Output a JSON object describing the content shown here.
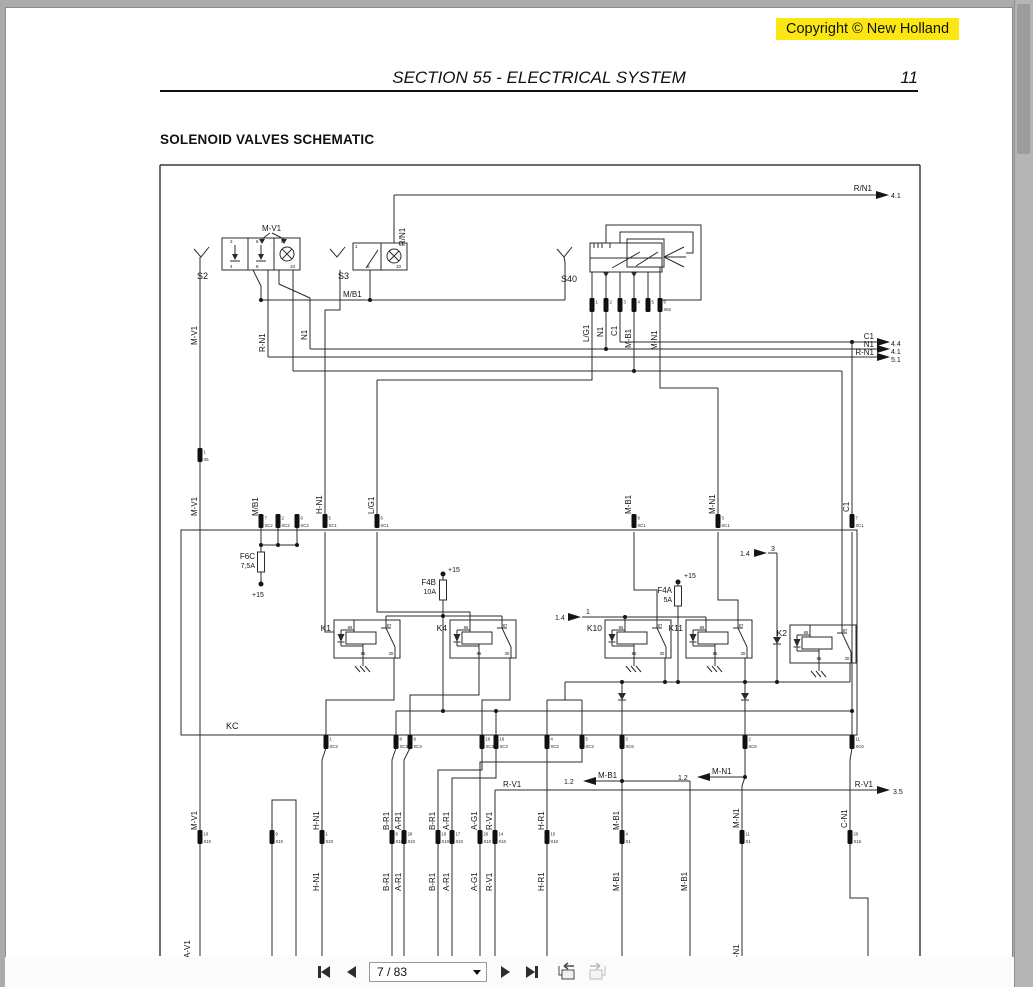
{
  "page": {
    "copyright": "Copyright © New Holland",
    "copyright_bg": "#fce712",
    "section_title": "SECTION 55 - ELECTRICAL SYSTEM",
    "page_number": "11",
    "heading": "SOLENOID VALVES SCHEMATIC"
  },
  "toolbar": {
    "page_indicator": "7 / 83"
  },
  "schematic": {
    "wire_color": "#2b2b2b",
    "labels": [
      {
        "t": "M-V1",
        "x": 262,
        "y": 231
      },
      {
        "t": "S2",
        "x": 197,
        "y": 279,
        "s": 9
      },
      {
        "t": "S3",
        "x": 338,
        "y": 279,
        "s": 9
      },
      {
        "t": "S40",
        "x": 561,
        "y": 282,
        "s": 9
      },
      {
        "t": "R/N1",
        "x": 405,
        "y": 246,
        "r": 1
      },
      {
        "t": "M/B1",
        "x": 343,
        "y": 297
      },
      {
        "t": "R/N1",
        "x": 872,
        "y": 191,
        "a": "e"
      },
      {
        "t": "4.1",
        "x": 891,
        "y": 198,
        "s": 7
      },
      {
        "t": "C1",
        "x": 874,
        "y": 339,
        "a": "e"
      },
      {
        "t": "4.4",
        "x": 891,
        "y": 346,
        "s": 7
      },
      {
        "t": "N1",
        "x": 874,
        "y": 347,
        "a": "e"
      },
      {
        "t": "4.1",
        "x": 891,
        "y": 354,
        "s": 7
      },
      {
        "t": "R-N1",
        "x": 874,
        "y": 355,
        "a": "e"
      },
      {
        "t": "5.1",
        "x": 891,
        "y": 362,
        "s": 7
      },
      {
        "t": "M-V1",
        "x": 197,
        "y": 345,
        "r": 1
      },
      {
        "t": "R-N1",
        "x": 265,
        "y": 352,
        "r": 1
      },
      {
        "t": "N1",
        "x": 307,
        "y": 340,
        "r": 1
      },
      {
        "t": "L/G1",
        "x": 589,
        "y": 342,
        "r": 1
      },
      {
        "t": "N1",
        "x": 603,
        "y": 337,
        "r": 1
      },
      {
        "t": "C1",
        "x": 617,
        "y": 336,
        "r": 1
      },
      {
        "t": "M-B1",
        "x": 631,
        "y": 348,
        "r": 1
      },
      {
        "t": "M-N1",
        "x": 657,
        "y": 350,
        "r": 1
      },
      {
        "t": "M-V1",
        "x": 197,
        "y": 516,
        "r": 1
      },
      {
        "t": "M/B1",
        "x": 258,
        "y": 516,
        "r": 1
      },
      {
        "t": "H-N1",
        "x": 322,
        "y": 514,
        "r": 1
      },
      {
        "t": "L/G1",
        "x": 374,
        "y": 514,
        "r": 1
      },
      {
        "t": "M-B1",
        "x": 631,
        "y": 514,
        "r": 1
      },
      {
        "t": "M-N1",
        "x": 715,
        "y": 514,
        "r": 1
      },
      {
        "t": "C1",
        "x": 849,
        "y": 512,
        "r": 1
      },
      {
        "t": "F6C",
        "x": 255,
        "y": 559,
        "a": "e"
      },
      {
        "t": "7,5A",
        "x": 255,
        "y": 568,
        "a": "e",
        "s": 7
      },
      {
        "t": "+15",
        "x": 252,
        "y": 597,
        "s": 7
      },
      {
        "t": "F4B",
        "x": 436,
        "y": 585,
        "a": "e"
      },
      {
        "t": "10A",
        "x": 436,
        "y": 594,
        "a": "e",
        "s": 7
      },
      {
        "t": "+15",
        "x": 448,
        "y": 572,
        "s": 7
      },
      {
        "t": "F4A",
        "x": 672,
        "y": 593,
        "a": "e"
      },
      {
        "t": "5A",
        "x": 672,
        "y": 602,
        "a": "e",
        "s": 7
      },
      {
        "t": "+15",
        "x": 684,
        "y": 578,
        "s": 7
      },
      {
        "t": "1.4",
        "x": 555,
        "y": 620,
        "s": 7
      },
      {
        "t": "1",
        "x": 586,
        "y": 614,
        "s": 7
      },
      {
        "t": "1.4",
        "x": 740,
        "y": 556,
        "s": 7
      },
      {
        "t": "3",
        "x": 771,
        "y": 551,
        "s": 7
      },
      {
        "t": "KC",
        "x": 226,
        "y": 729,
        "s": 9
      },
      {
        "t": "1.2",
        "x": 564,
        "y": 784,
        "s": 7
      },
      {
        "t": "M-B1",
        "x": 598,
        "y": 778
      },
      {
        "t": "1.2",
        "x": 678,
        "y": 780,
        "s": 7
      },
      {
        "t": "M-N1",
        "x": 712,
        "y": 774
      },
      {
        "t": "R-V1",
        "x": 503,
        "y": 787
      },
      {
        "t": "R-V1",
        "x": 873,
        "y": 787,
        "a": "e"
      },
      {
        "t": "3.5",
        "x": 893,
        "y": 794,
        "s": 7
      },
      {
        "t": "M-V1",
        "x": 197,
        "y": 830,
        "r": 1
      },
      {
        "t": "H-N1",
        "x": 319,
        "y": 830,
        "r": 1
      },
      {
        "t": "B-R1",
        "x": 389,
        "y": 830,
        "r": 1
      },
      {
        "t": "A-R1",
        "x": 401,
        "y": 830,
        "r": 1
      },
      {
        "t": "B-R1",
        "x": 435,
        "y": 830,
        "r": 1
      },
      {
        "t": "A-R1",
        "x": 449,
        "y": 830,
        "r": 1
      },
      {
        "t": "A-G1",
        "x": 477,
        "y": 830,
        "r": 1
      },
      {
        "t": "R-V1",
        "x": 492,
        "y": 830,
        "r": 1
      },
      {
        "t": "H-R1",
        "x": 544,
        "y": 830,
        "r": 1
      },
      {
        "t": "M-B1",
        "x": 619,
        "y": 830,
        "r": 1
      },
      {
        "t": "M-N1",
        "x": 739,
        "y": 828,
        "r": 1
      },
      {
        "t": "C-N1",
        "x": 847,
        "y": 828,
        "r": 1
      },
      {
        "t": "H-N1",
        "x": 319,
        "y": 891,
        "r": 1
      },
      {
        "t": "B-R1",
        "x": 389,
        "y": 891,
        "r": 1
      },
      {
        "t": "A-R1",
        "x": 401,
        "y": 891,
        "r": 1
      },
      {
        "t": "B-R1",
        "x": 435,
        "y": 891,
        "r": 1
      },
      {
        "t": "A-R1",
        "x": 449,
        "y": 891,
        "r": 1
      },
      {
        "t": "A-G1",
        "x": 477,
        "y": 891,
        "r": 1
      },
      {
        "t": "R-V1",
        "x": 492,
        "y": 891,
        "r": 1
      },
      {
        "t": "H-R1",
        "x": 544,
        "y": 891,
        "r": 1
      },
      {
        "t": "M-B1",
        "x": 619,
        "y": 891,
        "r": 1
      },
      {
        "t": "M-B1",
        "x": 687,
        "y": 891,
        "r": 1
      },
      {
        "t": "A-V1",
        "x": 190,
        "y": 958,
        "r": 1
      },
      {
        "t": "M-N1",
        "x": 739,
        "y": 964,
        "r": 1
      },
      {
        "t": "2",
        "x": 230,
        "y": 243,
        "s": 4.5
      },
      {
        "t": "6",
        "x": 256,
        "y": 243,
        "s": 4.5
      },
      {
        "t": "9",
        "x": 281,
        "y": 243,
        "s": 4.5
      },
      {
        "t": "4",
        "x": 230,
        "y": 268,
        "s": 4.5
      },
      {
        "t": "8",
        "x": 256,
        "y": 268,
        "s": 4.5
      },
      {
        "t": "10",
        "x": 290,
        "y": 268,
        "s": 4.5
      },
      {
        "t": "1",
        "x": 355,
        "y": 248,
        "s": 4.5
      },
      {
        "t": "9",
        "x": 367,
        "y": 268,
        "s": 4.5
      },
      {
        "t": "10",
        "x": 396,
        "y": 268,
        "s": 4.5
      }
    ],
    "pins": [
      {
        "x": 592,
        "y": 305,
        "n": "1",
        "c": ""
      },
      {
        "x": 606,
        "y": 305,
        "n": "2",
        "c": ""
      },
      {
        "x": 620,
        "y": 305,
        "n": "3",
        "c": ""
      },
      {
        "x": 634,
        "y": 305,
        "n": "4",
        "c": ""
      },
      {
        "x": 648,
        "y": 305,
        "n": "5",
        "c": ""
      },
      {
        "x": 660,
        "y": 305,
        "n": "6",
        "c": "X62"
      },
      {
        "x": 200,
        "y": 455,
        "n": "1",
        "c": "X6"
      },
      {
        "x": 261,
        "y": 521,
        "n": "7",
        "c": "XC2"
      },
      {
        "x": 278,
        "y": 521,
        "n": "2",
        "c": "XC2"
      },
      {
        "x": 297,
        "y": 521,
        "n": "6",
        "c": "XC2"
      },
      {
        "x": 325,
        "y": 521,
        "n": "5",
        "c": "XC1"
      },
      {
        "x": 377,
        "y": 521,
        "n": "6",
        "c": "XC1"
      },
      {
        "x": 634,
        "y": 521,
        "n": "8",
        "c": "XC1"
      },
      {
        "x": 718,
        "y": 521,
        "n": "3",
        "c": "XC1"
      },
      {
        "x": 852,
        "y": 521,
        "n": "7",
        "c": "XC1"
      },
      {
        "x": 326,
        "y": 742,
        "n": "1",
        "c": "XC3"
      },
      {
        "x": 396,
        "y": 742,
        "n": "8",
        "c": "XC3"
      },
      {
        "x": 410,
        "y": 742,
        "n": "9",
        "c": "XC3"
      },
      {
        "x": 482,
        "y": 742,
        "n": "19",
        "c": "XC3"
      },
      {
        "x": 496,
        "y": 742,
        "n": "16",
        "c": "XC3"
      },
      {
        "x": 547,
        "y": 742,
        "n": "4",
        "c": "XC3"
      },
      {
        "x": 582,
        "y": 742,
        "n": "5",
        "c": "XC3"
      },
      {
        "x": 622,
        "y": 742,
        "n": "3",
        "c": "XC6"
      },
      {
        "x": 745,
        "y": 742,
        "n": "2",
        "c": "XC6"
      },
      {
        "x": 852,
        "y": 742,
        "n": "11",
        "c": "XC6"
      },
      {
        "x": 200,
        "y": 837,
        "n": "10",
        "c": "X10"
      },
      {
        "x": 272,
        "y": 837,
        "n": "9",
        "c": "X10"
      },
      {
        "x": 322,
        "y": 837,
        "n": "1",
        "c": "X10"
      },
      {
        "x": 392,
        "y": 837,
        "n": "8",
        "c": "X10"
      },
      {
        "x": 404,
        "y": 837,
        "n": "28",
        "c": "X10"
      },
      {
        "x": 438,
        "y": 837,
        "n": "18",
        "c": "X10"
      },
      {
        "x": 452,
        "y": 837,
        "n": "17",
        "c": "X10"
      },
      {
        "x": 480,
        "y": 837,
        "n": "26",
        "c": "X10"
      },
      {
        "x": 495,
        "y": 837,
        "n": "14",
        "c": "X10"
      },
      {
        "x": 547,
        "y": 837,
        "n": "10",
        "c": "X10"
      },
      {
        "x": 622,
        "y": 837,
        "n": "4",
        "c": "X1"
      },
      {
        "x": 742,
        "y": 837,
        "n": "11",
        "c": "X1"
      },
      {
        "x": 850,
        "y": 837,
        "n": "20",
        "c": "X16"
      }
    ],
    "arrows": [
      {
        "x": 876,
        "y": 195,
        "d": "r"
      },
      {
        "x": 877,
        "y": 342,
        "d": "r"
      },
      {
        "x": 877,
        "y": 349,
        "d": "r"
      },
      {
        "x": 877,
        "y": 357,
        "d": "r"
      },
      {
        "x": 568,
        "y": 617,
        "d": "r"
      },
      {
        "x": 754,
        "y": 553,
        "d": "r"
      },
      {
        "x": 877,
        "y": 790,
        "d": "r"
      },
      {
        "x": 596,
        "y": 781,
        "d": "l"
      },
      {
        "x": 710,
        "y": 777,
        "d": "l"
      }
    ],
    "dots": [
      [
        261,
        300
      ],
      [
        370,
        300
      ],
      [
        606,
        349
      ],
      [
        634,
        371
      ],
      [
        852,
        342
      ],
      [
        261,
        545
      ],
      [
        278,
        545
      ],
      [
        297,
        545
      ],
      [
        443,
        616
      ],
      [
        443,
        711
      ],
      [
        496,
        711
      ],
      [
        625,
        617
      ],
      [
        622,
        682
      ],
      [
        665,
        682
      ],
      [
        678,
        682
      ],
      [
        745,
        682
      ],
      [
        777,
        682
      ],
      [
        622,
        781
      ],
      [
        745,
        777
      ],
      [
        852,
        711
      ]
    ],
    "power_dots": [
      [
        261,
        584
      ],
      [
        443,
        574
      ],
      [
        678,
        582
      ]
    ],
    "relays": [
      {
        "t": "K1",
        "x": 334,
        "y": 620,
        "g": 363
      },
      {
        "t": "K4",
        "x": 450,
        "y": 620,
        "g": null
      },
      {
        "t": "K10",
        "x": 605,
        "y": 620,
        "g": 634
      },
      {
        "t": "K11",
        "x": 686,
        "y": 620,
        "g": 715
      },
      {
        "t": "K2",
        "x": 790,
        "y": 625,
        "g": 819
      }
    ],
    "relay_pin_names": [
      "86",
      "87",
      "85",
      "30"
    ]
  }
}
